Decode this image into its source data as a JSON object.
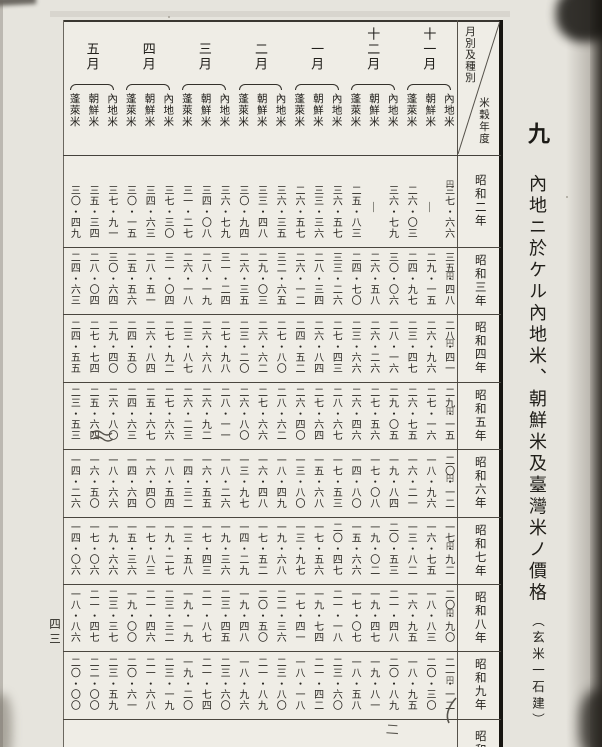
{
  "colors": {
    "ink": "#26241f",
    "pencil": "#56534c",
    "paper": "#efede6"
  },
  "page_number": "四三",
  "title": {
    "index": "九",
    "main": "內地ニ於ケル內地米、朝鮮米及臺灣米ノ價格",
    "sub": "（玄米一石建）"
  },
  "corner": {
    "diagonal_top": "月別及種別",
    "diagonal_bottom": "米穀年度"
  },
  "unit": "円",
  "months": [
    "十一月",
    "十二月",
    "一月",
    "二月",
    "三月",
    "四月",
    "五月"
  ],
  "varieties": [
    "內地米",
    "朝鮮米",
    "蓬萊米"
  ],
  "rows": [
    {
      "year": "昭和二年",
      "cells": [
        [
          "三七・六六",
          "―",
          "二六・〇三"
        ],
        [
          "三六・七九",
          "―",
          "二五・八三"
        ],
        [
          "三六・五七",
          "三三・三六",
          "二六・五七"
        ],
        [
          "三六・三五",
          "三三・四八",
          "三〇・九四"
        ],
        [
          "三六・七九",
          "三四・〇八",
          "三一・二七"
        ],
        [
          "三七・三〇",
          "三四・六三",
          "三〇・一五"
        ],
        [
          "三七・九一",
          "三五・三四",
          "三〇・四九"
        ]
      ]
    },
    {
      "year": "昭和三年",
      "cells": [
        [
          "三五・四八",
          "二九・一五",
          "二四・九七"
        ],
        [
          "三〇・〇六",
          "二六・五八",
          "二四・七〇"
        ],
        [
          "三三・二六",
          "二八・三四",
          "二六・一二"
        ],
        [
          "三二・六五",
          "二九・〇三",
          "二六・三五"
        ],
        [
          "三一・二四",
          "二八・一九",
          "二六・一八"
        ],
        [
          "三一・〇四",
          "二八・五一",
          "二五・五六"
        ],
        [
          "三〇・六四",
          "二八・〇四",
          "二四・六三"
        ]
      ]
    },
    {
      "year": "昭和四年",
      "cells": [
        [
          "二八・四一",
          "二六・九六",
          "二三・四七"
        ],
        [
          "二八・一六",
          "二六・二六",
          "二三・六六"
        ],
        [
          "二七・四三",
          "二六・八四",
          "二四・五二"
        ],
        [
          "二七・八〇",
          "二六・六二",
          "二三・二〇"
        ],
        [
          "二七・九八",
          "二六・六八",
          "二三・八七"
        ],
        [
          "二七・九二",
          "二六・八四",
          "二四・五〇"
        ],
        [
          "二九・四〇",
          "二七・七四",
          "二四・五五"
        ]
      ]
    },
    {
      "year": "昭和五年",
      "cells": [
        [
          "二九・一五",
          "二七・一六",
          "二六・七五"
        ],
        [
          "二九・〇五",
          "二七・五六",
          "二六・四六"
        ],
        [
          "二八・六七",
          "二七・六四",
          "二六・四〇"
        ],
        [
          "二八・六二",
          "二七・六六",
          "二六・八〇"
        ],
        [
          "二八・一一",
          "二六・九二",
          "二六・二三"
        ],
        [
          "二七・六六",
          "二五・六七",
          "二四・六三"
        ],
        [
          "二六・八〇",
          "二五・六四",
          "二三・五三"
        ]
      ]
    },
    {
      "year": "昭和六年",
      "cells": [
        [
          "二〇・一二",
          "一八・九六",
          "一六・二一"
        ],
        [
          "一九・八四",
          "一七・〇八",
          "一四・八〇"
        ],
        [
          "一七・五三",
          "一五・六八",
          "一三・八〇"
        ],
        [
          "一八・四九",
          "一六・四八",
          "一三・九七"
        ],
        [
          "一八・二六",
          "一六・五五",
          "一四・三二"
        ],
        [
          "一八・五四",
          "一六・四〇",
          "一四・六四"
        ],
        [
          "一八・六六",
          "一六・五〇",
          "一四・二六"
        ]
      ]
    },
    {
      "year": "昭和七年",
      "cells": [
        [
          "一七・九二",
          "一六・七五",
          "一三・八二"
        ],
        [
          "二〇・五三",
          "一九・〇二",
          "一五・六六"
        ],
        [
          "二〇・四七",
          "一七・五六",
          "一三・九七"
        ],
        [
          "一九・六八",
          "一七・五二",
          "一四・二九"
        ],
        [
          "一九・三六",
          "一七・四三",
          "一三・五八"
        ],
        [
          "一九・二七",
          "一七・八三",
          "一五・三六"
        ],
        [
          "一九・六六",
          "一七・〇六",
          "一四・〇六"
        ]
      ]
    },
    {
      "year": "昭和八年",
      "cells": [
        [
          "二〇・九〇",
          "一八・八三",
          "一六・九五"
        ],
        [
          "二一・四八",
          "一九・四七",
          "一七・〇七"
        ],
        [
          "二一・一八",
          "一九・七四",
          "一七・四一"
        ],
        [
          "二二・三六",
          "二〇・五〇",
          "一九・四八"
        ],
        [
          "二三・四五",
          "二一・八七",
          "一九・一九"
        ],
        [
          "二三・三二",
          "二一・四六",
          "一九・〇〇"
        ],
        [
          "二三・三七",
          "二一・四七",
          "一八・八六"
        ]
      ]
    },
    {
      "year": "昭和九年",
      "cells": [
        [
          "二一・一二",
          "二〇・三〇",
          "一八・九五"
        ],
        [
          "二〇・八九",
          "一九・八一",
          "一八・五八"
        ],
        [
          "二三・六〇",
          "二一・四二",
          "一八・一八"
        ],
        [
          "二三・八〇",
          "二一・八九",
          "一八・九六"
        ],
        [
          "二三・六〇",
          "二一・七四",
          "一九・二〇"
        ],
        [
          "二三・一九",
          "二一・六八",
          "二〇・六一"
        ],
        [
          "二三・五九",
          "二二・〇〇",
          "二〇・〇〇"
        ]
      ]
    }
  ],
  "partial_row": {
    "year": "昭和"
  },
  "annotations": {
    "pencil_bottom_mark": "二"
  }
}
